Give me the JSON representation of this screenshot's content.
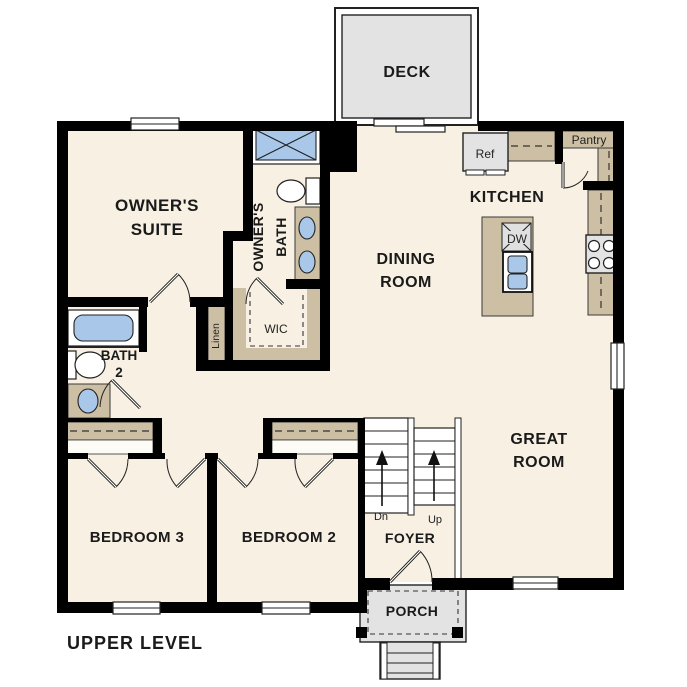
{
  "level_label": "UPPER LEVEL",
  "colors": {
    "floor": "#f7f0e3",
    "wall": "#000000",
    "casework": "#cdbfa3",
    "fixture_blue": "#a9c8e9",
    "concrete": "#e3e3e3",
    "text": "#1a1a1a"
  },
  "rooms": {
    "deck": {
      "label": "DECK"
    },
    "owners_suite": {
      "line1": "OWNER'S",
      "line2": "SUITE"
    },
    "owners_bath": {
      "line1": "OWNER'S",
      "line2": "BATH"
    },
    "kitchen": {
      "label": "KITCHEN"
    },
    "dining_room": {
      "line1": "DINING",
      "line2": "ROOM"
    },
    "great_room": {
      "line1": "GREAT",
      "line2": "ROOM"
    },
    "bath2": {
      "line1": "BATH",
      "line2": "2"
    },
    "bedroom3": {
      "label": "BEDROOM 3"
    },
    "bedroom2": {
      "label": "BEDROOM 2"
    },
    "foyer": {
      "label": "FOYER"
    },
    "porch": {
      "label": "PORCH"
    },
    "wic": {
      "label": "WIC"
    },
    "linen": {
      "label": "Linen"
    },
    "pantry": {
      "label": "Pantry"
    }
  },
  "fixtures": {
    "refrigerator_label": "Ref",
    "dishwasher_label": "DW"
  },
  "stairs": {
    "down_label": "Dn",
    "up_label": "Up"
  }
}
